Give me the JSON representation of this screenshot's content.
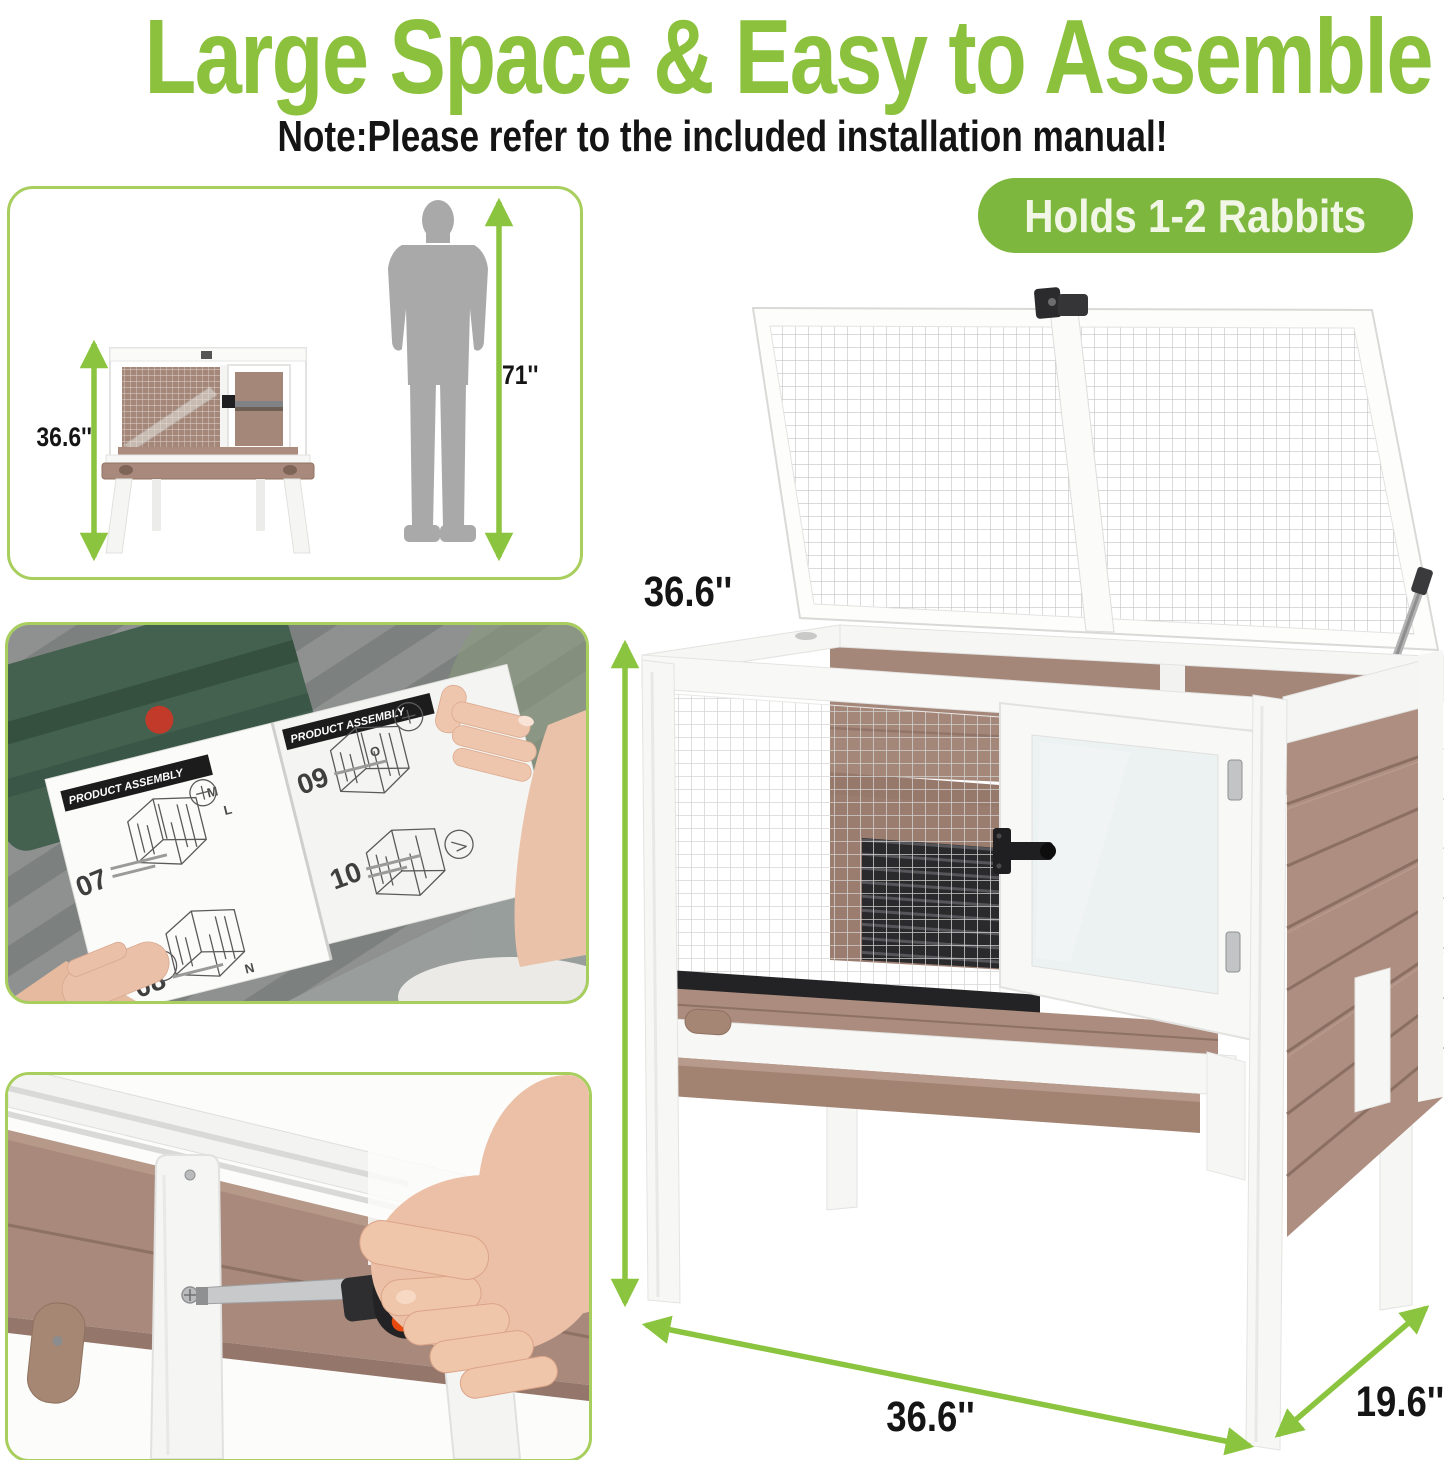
{
  "page": {
    "title": "Large Space & Easy to Assemble",
    "note": "Note:Please refer to the included installation manual!"
  },
  "badge": {
    "label": "Holds 1-2 Rabbits"
  },
  "size_comparison": {
    "hutch_height": "36.6''",
    "person_height": "71''"
  },
  "product_dimensions": {
    "height": "36.6''",
    "width": "36.6''",
    "depth": "19.6''"
  },
  "manual_page": {
    "header": "PRODUCT ASSEMBLY",
    "steps": [
      "07",
      "08",
      "09",
      "10"
    ],
    "part_letters": [
      "M",
      "L",
      "O",
      "N"
    ]
  },
  "colors": {
    "accent_green": "#8cc13d",
    "badge_green": "#7db73d",
    "border_green": "#a8ce5e",
    "arrow_green": "#8bc43e",
    "wood_brown": "#ad8e80",
    "wood_brown_dark": "#8b6f62",
    "frame_white": "#f6f6f4",
    "shelf_dark": "#3a3b3f",
    "silhouette_gray": "#a9a9a9",
    "screwdriver_red": "#e8490f"
  }
}
